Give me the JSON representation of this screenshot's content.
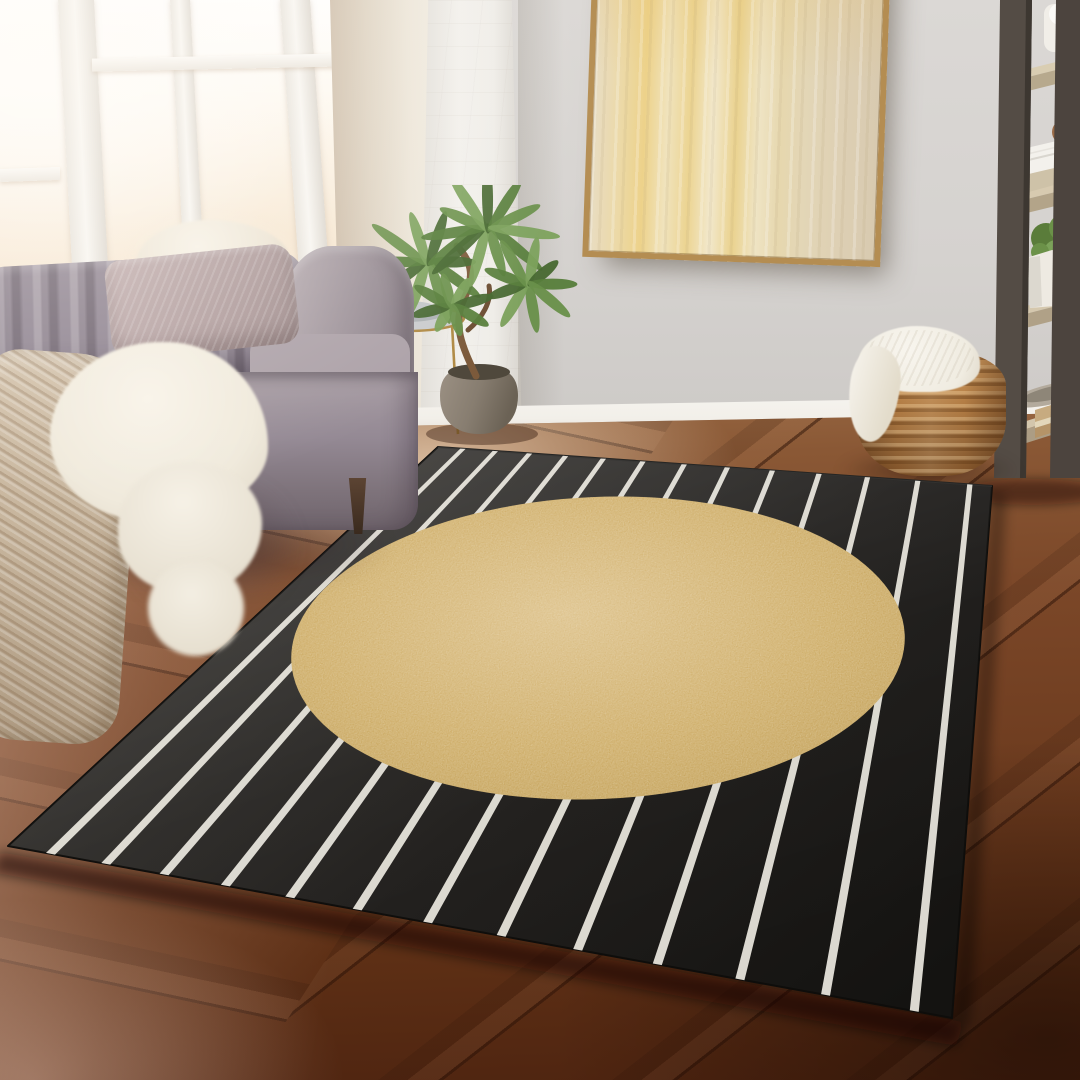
{
  "meta": {
    "title": "Living room photo: black area rug with thin white diagonal stripes and large gold circle, gray velvet sofa, tall bright windows, abstract gold wall art, ladder shelf and woven basket on dark hardwood floor",
    "width": 1080,
    "height": 1080
  },
  "palette": {
    "wall": "#d5d2cf",
    "wallTop": "#dbd8d5",
    "wallDim": "#cbc8c5",
    "glassWarm": "#f7e8d3",
    "glassDeep": "#efd6b6",
    "frameWhite": "#f8f6f2",
    "jambShadow": "#cdbda9",
    "column": "#f2f0ec",
    "baseboard": "#f2efe9",
    "floorLight": "#9a6b46",
    "floorMid": "#7b4728",
    "floorDark": "#4e2410",
    "paintFrame": "#b48d52",
    "sofaLight": "#b0a5ab",
    "sofaDark": "#6f646c",
    "pillowFur": "#ece4d4",
    "pillowMauve": "#ab9798",
    "throwKnit": "#c6b49c",
    "throwFur": "#f0eadc",
    "wood": "#3a2a1e",
    "basket": "#b07a42",
    "basketLight": "#d09c60",
    "basketDark": "#7e5026",
    "knitWhite": "#f0ece1",
    "shelfRail": "#544c45",
    "shelfRailDark": "#3d3731",
    "shelfWood": "#d7cab0",
    "shelfWoodFront": "#b7a98d",
    "plantGreen": "#567836",
    "plantGreenLight": "#76a055",
    "potClay": "#8b8174",
    "trunk": "#7c5a3b",
    "goldTable": "#b08a45",
    "plate": "#b9bdc0",
    "rugBlackLight": "#34322f",
    "rugBlack": "#201e1c",
    "rugBlackDeep": "#141311",
    "rugStripe": "#e8e5dc",
    "rugGoldLight": "#dcc088",
    "rugGold": "#cdab64",
    "rugGoldDeep": "#bd9a50"
  },
  "rug": {
    "corners": {
      "A": [
        438,
        447
      ],
      "B": [
        992,
        486
      ],
      "C": [
        952,
        1018
      ],
      "D": [
        8,
        846
      ]
    },
    "stripes": {
      "count": 13,
      "margin_left": 0.045,
      "margin_right": 0.04,
      "width": 0.0095,
      "gap_growth": 0.055
    },
    "circle": {
      "cx": 598,
      "cy": 648,
      "rx": 307,
      "ry": 151,
      "rotate": -2.5
    }
  },
  "plant": {
    "rosettes": [
      {
        "cx": 428,
        "cy": 262,
        "leaves": 10,
        "len": 64
      },
      {
        "cx": 488,
        "cy": 228,
        "leaves": 11,
        "len": 68
      },
      {
        "cx": 528,
        "cy": 284,
        "leaves": 9,
        "len": 50
      },
      {
        "cx": 452,
        "cy": 306,
        "leaves": 8,
        "len": 40
      }
    ],
    "leaf_colors": [
      "#46672f",
      "#567d3a",
      "#688f49",
      "#7aa05a"
    ]
  },
  "objects": {
    "rug": "black and white striped rug with gold circle",
    "sofa": "gray velvet channel-tufted sofa",
    "painting": "gold abstract framed canvas",
    "shelf": "dark ladder shelf with oak shelves",
    "basket": "woven rattan basket with white knit throw",
    "plant": "potted houseplant",
    "table": "round gold side table with plates",
    "window": "tall bright windows",
    "floor": "dark hardwood floor"
  }
}
